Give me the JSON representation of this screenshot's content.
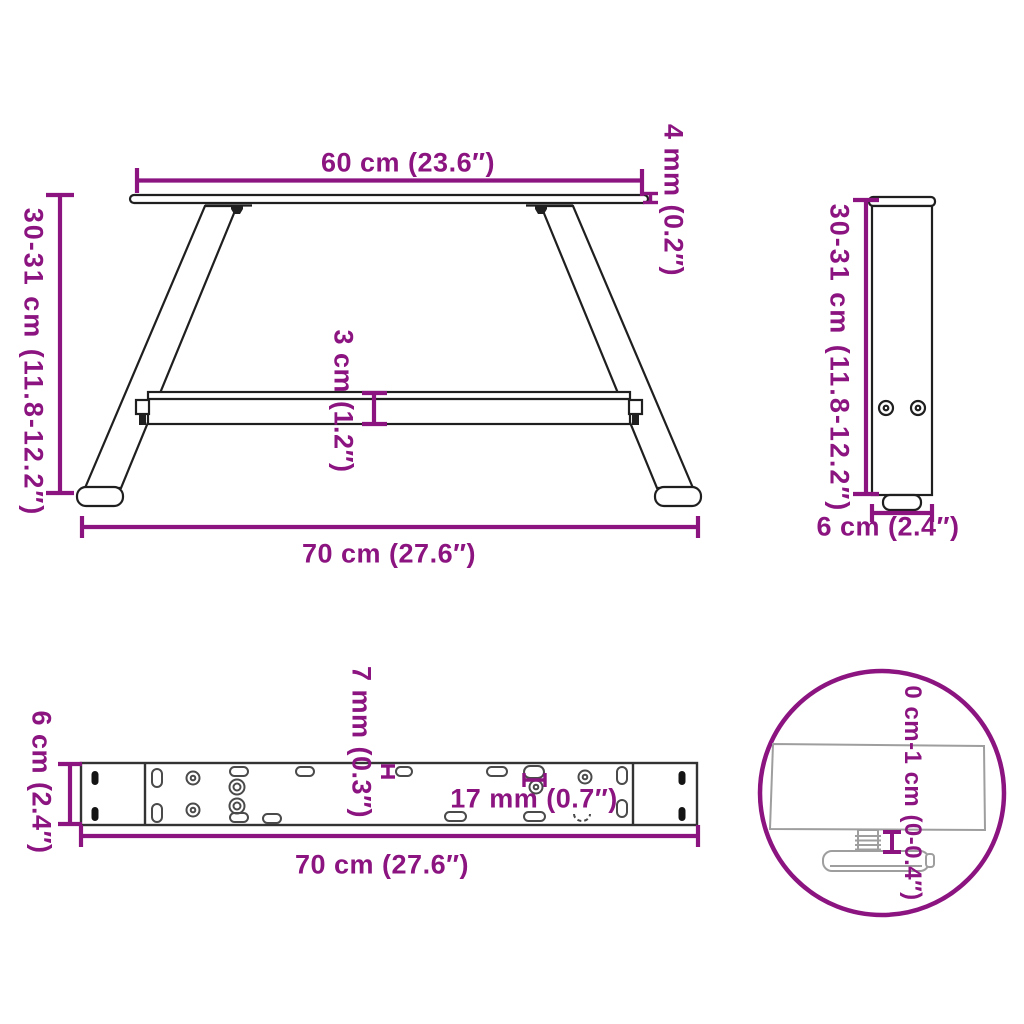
{
  "diagram_title": "table-leg-dimension-diagram",
  "colors": {
    "dimension_purple": "#8B1480",
    "drawing_dark": "#1f1f1f",
    "drawing_mid": "#333333",
    "hole_gray": "#4a4a4a",
    "detail_gray": "#9e9e9e",
    "background": "#ffffff"
  },
  "labels": {
    "front_top_width": "60 cm (23.6″)",
    "front_height": "30-31 cm (11.8-12.2″)",
    "front_plate_thickness": "4 mm (0.2″)",
    "front_crossbar_thickness": "3 cm (1.2″)",
    "front_bottom_width": "70 cm (27.6″)",
    "side_height": "30-31 cm (11.8-12.2″)",
    "side_depth": "6 cm (2.4″)",
    "top_depth": "6 cm (2.4″)",
    "top_hole_diameter": "7 mm (0.3″)",
    "top_slot_length": "17 mm (0.7″)",
    "top_length": "70 cm (27.6″)",
    "detail_adjustable_height": "0 cm-1 cm (0-0.4″)"
  }
}
